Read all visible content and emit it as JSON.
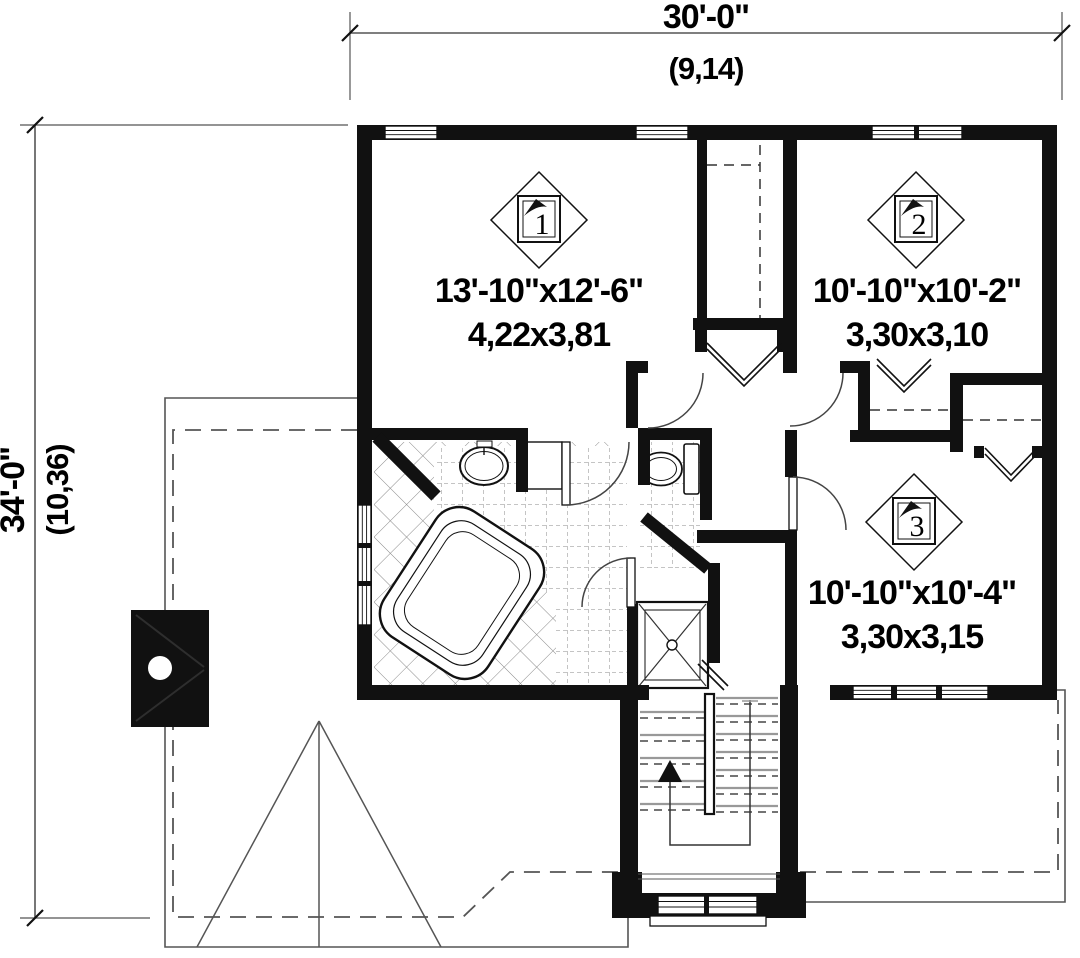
{
  "title": "Second floor plan",
  "colors": {
    "wall": "#111111",
    "thin_line": "#555555",
    "tile_line": "#8a8a8a",
    "text": "#000000",
    "background": "#ffffff"
  },
  "dimensions": {
    "width": {
      "imperial": "30'-0\"",
      "metric": "(9,14)"
    },
    "depth": {
      "imperial": "34'-0\"",
      "metric": "(10,36)"
    }
  },
  "rooms": [
    {
      "number": "1",
      "imperial": "13'-10\"x12'-6\"",
      "metric": "4,22x3,81"
    },
    {
      "number": "2",
      "imperial": "10'-10\"x10'-2\"",
      "metric": "3,30x3,10"
    },
    {
      "number": "3",
      "imperial": "10'-10\"x10'-4\"",
      "metric": "3,30x3,15"
    }
  ],
  "fixtures": {
    "bathtub": "corner bathtub",
    "sink": "vanity sink",
    "toilet": "toilet",
    "shower": "shower stall",
    "stairs": "stairs up",
    "chimney": "chimney"
  }
}
